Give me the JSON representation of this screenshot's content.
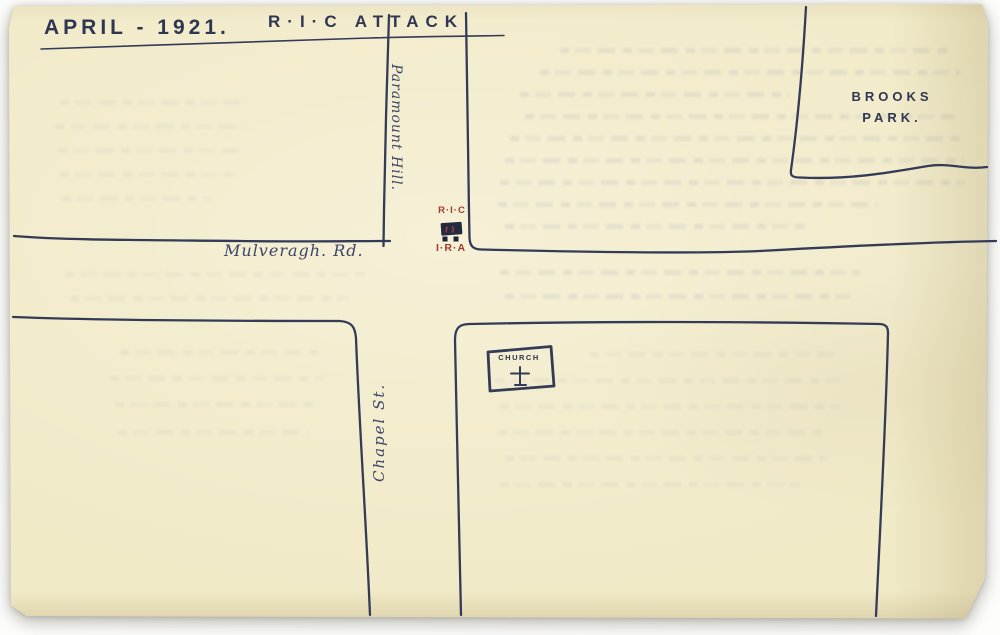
{
  "title": {
    "date": "APRIL - 1921.",
    "event": "R·I·C  ATTACK"
  },
  "places": {
    "brooks_park_line1": "BROOKS",
    "brooks_park_line2": "PARK.",
    "road_label": "Mulveragh. Rd.",
    "hill_label": "Paramount Hill.",
    "street_label": "Chapel St.",
    "church_label": "CHURCH"
  },
  "markers": {
    "ric": "R·I·C",
    "ira": "I·R·A"
  },
  "colors": {
    "paper": "#f1eac7",
    "ink": "#333b57",
    "marker_red": "#a23b2b",
    "background": "#fdfdfc"
  }
}
